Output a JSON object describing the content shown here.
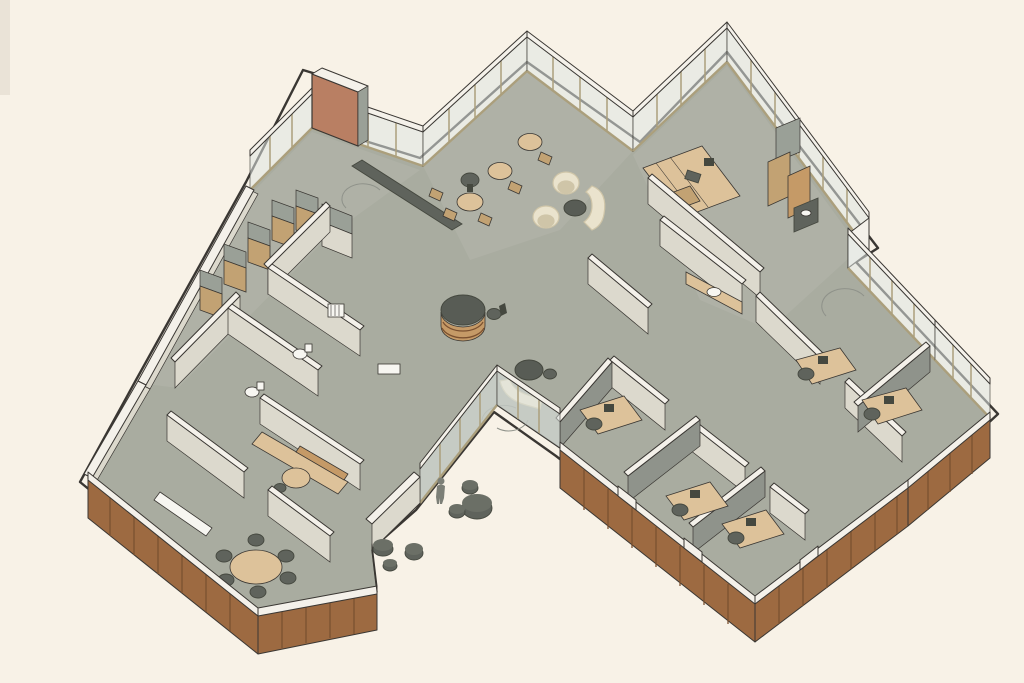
{
  "palette": {
    "background": "#f8f2e7",
    "ink": "#3a3733",
    "floor": "#a9aca0",
    "floor_light": "#b6b8ac",
    "wall_cap": "#f4f1ea",
    "wall_face_light": "#dcd9cd",
    "wall_face_shadow": "#8f938b",
    "wall_gray": "#9aa097",
    "wood": "#9d6a41",
    "wood_dark": "#7b5130",
    "wood_light": "#c59a67",
    "tan": "#ddc29a",
    "tan_dark": "#c2a273",
    "glass": "#dfe5e1",
    "glass_frame": "#ab9f7c",
    "furn_dark": "#5f635c",
    "furn_darker": "#45483f",
    "cream": "#eae3cd",
    "cream_dark": "#cfc5a8",
    "table_round": "#585c55",
    "terracotta": "#b97f63"
  },
  "scene": {
    "type": "isometric-architectural-floorplan-rendering",
    "style": "cutaway axonometric office interior on cream background, no visible text",
    "wings": [
      "left wing (storage corridor, restrooms, kitchenette, meeting room)",
      "central lounge-cafe hub with reception counter",
      "upper-right workroom",
      "right wing (corridor with private offices, kitchenette)"
    ],
    "materials": {
      "exterior_low_walls": "wood plank panels with white caps",
      "upper_edge_walls": "glass partitions with tan mullions and white caps",
      "interior_walls": "light warm gray with white caps",
      "floor": "gray-green carpet"
    },
    "furniture": {
      "cafe_round_tables": 3,
      "cafe_wood_chairs": 5,
      "cream_lounge_chairs": 2,
      "dark_coffee_tables": 2,
      "curved_cream_benches": 2,
      "reception_round_counter": 1,
      "workroom_work_tables": 2,
      "workroom_cabinets": 3,
      "office_desks_with_chairs": 5,
      "meeting_table_chairs": 6,
      "storage_lockers": 6,
      "toilets": 2,
      "sinks": 2,
      "outdoor_poufs": 6,
      "people": 1
    }
  }
}
